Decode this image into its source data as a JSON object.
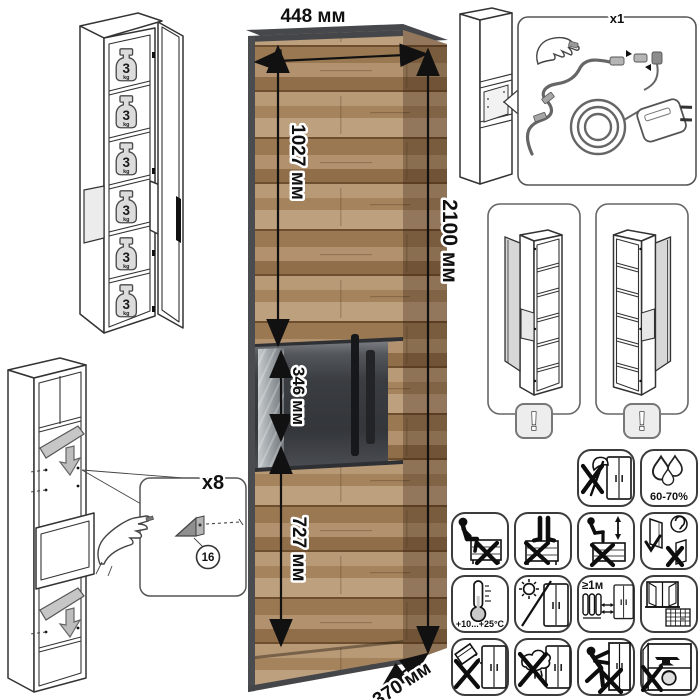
{
  "dimensions": {
    "width": "448 мм",
    "height": "2100 мм",
    "depth": "370 мм",
    "upper_door_height": "1027 мм",
    "middle_section_height": "346 мм",
    "lower_door_height": "727 мм"
  },
  "shelf_load": {
    "value": "3",
    "unit": "kg",
    "shelves_shown": 6
  },
  "electrical": {
    "qty": "x1"
  },
  "door_variants": {
    "warning": "!",
    "options": [
      "left-hand-door",
      "right-hand-door"
    ]
  },
  "assembly": {
    "qty": "x8",
    "part_no": "16"
  },
  "care_icons": [
    {
      "name": "no-sharp-tools-icon"
    },
    {
      "name": "humidity-icon",
      "label": "60-70%"
    },
    {
      "name": "no-sitting-icon"
    },
    {
      "name": "no-standing-icon"
    },
    {
      "name": "no-climbing-icon"
    },
    {
      "name": "door-click-check-icon"
    },
    {
      "name": "temperature-range-icon",
      "label": "+10...+25°C"
    },
    {
      "name": "no-direct-sunlight-icon"
    },
    {
      "name": "heater-distance-icon",
      "label": "≥1м"
    },
    {
      "name": "ventilation-icon"
    },
    {
      "name": "no-spill-icon"
    },
    {
      "name": "no-wet-cloth-icon"
    },
    {
      "name": "no-moving-loaded-icon"
    },
    {
      "name": "no-heavy-items-icon"
    }
  ],
  "colors": {
    "wood": "#b0906c",
    "wood_dark_seam": "#6d4e2f",
    "trim": "#46484c",
    "glass": "#3a3d41",
    "line_art": "#333333",
    "shelf_gray": "#c6c6c6"
  }
}
